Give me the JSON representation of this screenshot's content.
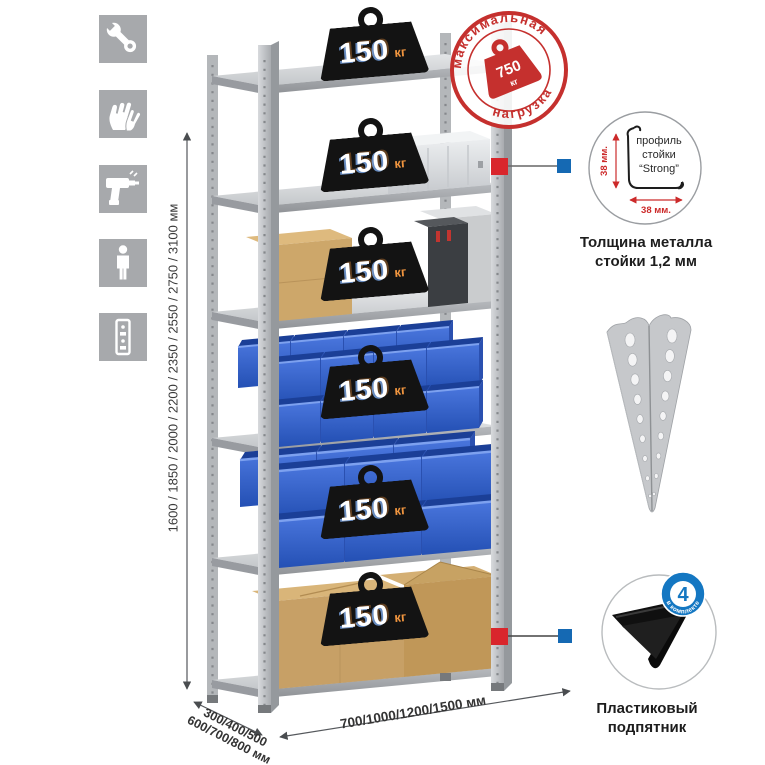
{
  "icons": [
    "wrench",
    "gloves",
    "drill",
    "person",
    "rack-post"
  ],
  "dimensions": {
    "height": "1600 / 1850 / 2000 / 2200 / 2350 / 2550 / 2750 / 3100 мм",
    "depth_line1": "300/400/500",
    "depth_line2": "600/700/800 мм",
    "width": "700/1000/1200/1500 мм"
  },
  "shelf_load": {
    "value": "150",
    "unit": "кг"
  },
  "max_load": {
    "arc_top": "максимальная",
    "arc_bottom": "нагрузка",
    "value": "750",
    "unit": "кг"
  },
  "profile": {
    "line1": "профиль",
    "line2": "стойки",
    "line3": "“Strong”",
    "dim_v": "38 мм.",
    "dim_h": "38 мм.",
    "caption1": "Толщина металла",
    "caption2": "стойки 1,2 мм"
  },
  "foot": {
    "badge_value": "4",
    "badge_arc": "в комплекте",
    "caption1": "Пластиковый",
    "caption2": "подпятник"
  },
  "colors": {
    "accent_red": "#cf2b2f",
    "accent_blue": "#1569b3",
    "bin_blue": "#2e5ec6",
    "icon_bg": "#a7a9ac",
    "metal": "#c3c5c8",
    "cardboard": "#c9a368",
    "unit_orange": "#f0953f"
  }
}
